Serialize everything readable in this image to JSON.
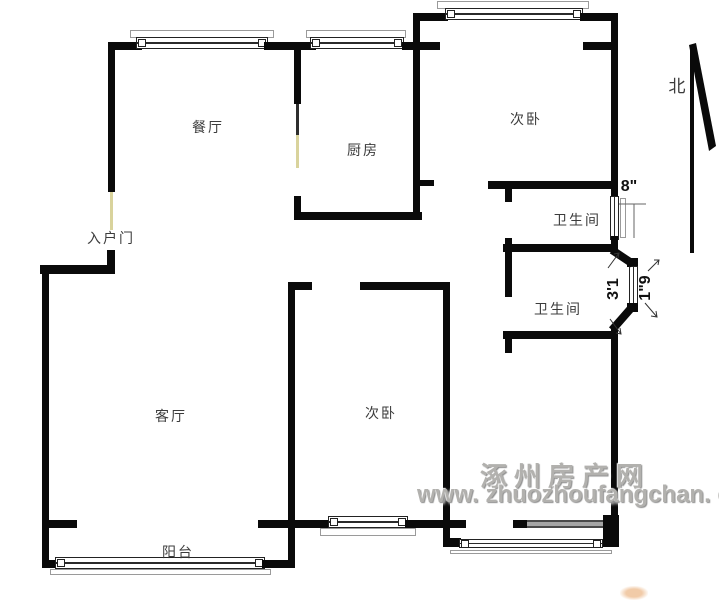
{
  "rooms": {
    "dining": {
      "label": "餐厅"
    },
    "kitchen": {
      "label": "厨房"
    },
    "bedroom_north": {
      "label": "次卧"
    },
    "bathroom_upper": {
      "label": "卫生间"
    },
    "bathroom_lower": {
      "label": "卫生间"
    },
    "entry": {
      "label": "入户门"
    },
    "living": {
      "label": "客厅"
    },
    "bedroom_south": {
      "label": "次卧"
    },
    "balcony": {
      "label": "阳台"
    }
  },
  "compass": {
    "north": "北"
  },
  "dimensions": {
    "bath_window": "8\"",
    "bay_depth": "3'1",
    "bay_window": "1\"9"
  },
  "watermark": {
    "site_name": "涿州房产网",
    "site_url": "www. zhuozhoufangchan. com"
  },
  "colors": {
    "wall": "#0a0a0a",
    "door": "#d9d39c",
    "label_text": "#3c3c3c",
    "watermark_text": "#b2b1ae",
    "dimension_text": "#111111"
  }
}
